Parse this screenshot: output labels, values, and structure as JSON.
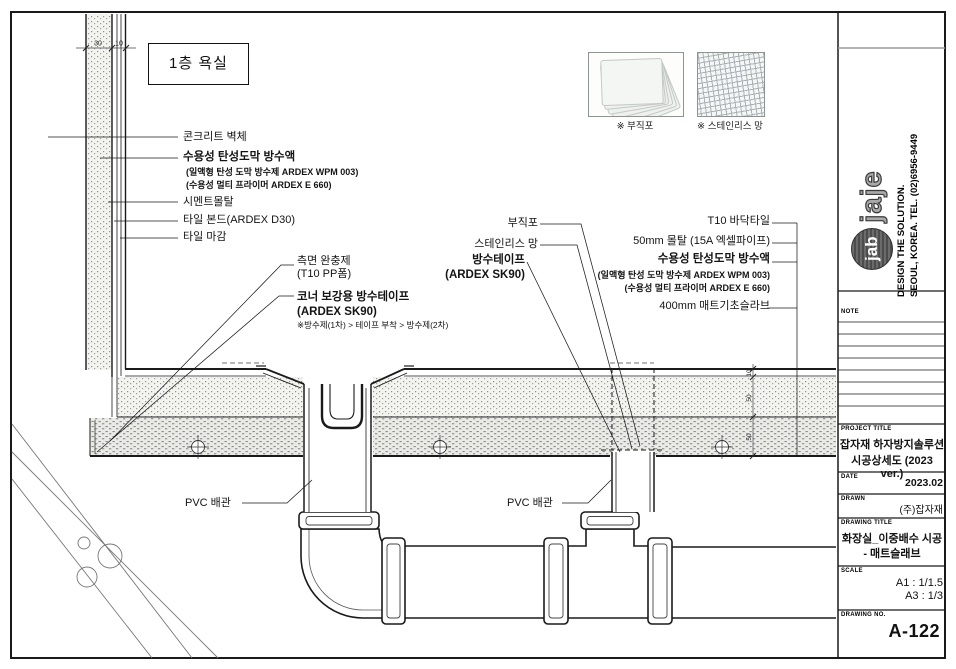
{
  "drawing": {
    "title_box": "1층 욕실",
    "legend": {
      "fabric_caption": "※ 부직포",
      "mesh_caption": "※ 스테인리스 망"
    },
    "wall_labels": {
      "concrete": "콘크리트 벽체",
      "waterproof_title": "수용성 탄성도막 방수액",
      "waterproof_sub1": "(일액형 탄성 도막 방수제 ARDEX WPM 003)",
      "waterproof_sub2": "(수용성 멀티 프라이머 ARDEX E 660)",
      "cement_mortar": "시멘트몰탈",
      "tile_bond": "타일 본드(ARDEX D30)",
      "tile_finish": "타일 마감"
    },
    "corner_labels": {
      "cushion_line1": "측면 완충제",
      "cushion_line2": "(T10 PP폼)",
      "tape_line1": "코너 보강용 방수테이프",
      "tape_line2": "(ARDEX SK90)",
      "tape_note": "※방수제(1차) > 테이프 부착 > 방수제(2차)"
    },
    "mid_labels": {
      "fabric": "부직포",
      "mesh": "스테인리스 망",
      "tape_line1": "방수테이프",
      "tape_line2": "(ARDEX SK90)"
    },
    "right_labels": {
      "floor_tile": "T10 바닥타일",
      "mortar": "50mm 몰탈  (15A 엑셀파이프)",
      "waterproof_title": "수용성 탄성도막 방수액",
      "waterproof_sub1": "(일액형 탄성 도막 방수제 ARDEX WPM 003)",
      "waterproof_sub2": "(수용성 멀티 프라이머 ARDEX E 660)",
      "slab": "400mm 매트기초슬라브"
    },
    "pvc_label_1": "PVC 배관",
    "pvc_label_2": "PVC 배관",
    "dims": {
      "wall_mortar": "30",
      "wall_tile": "10",
      "tile": "10",
      "mortar": "50",
      "bed": "50"
    }
  },
  "titleblock": {
    "logo_jab": "jab",
    "logo_jaje": "jaje",
    "tagline1": "DESIGN THE SOLUTION.",
    "tagline2": "SEOUL, KOREA. TEL. (02)6956-9449",
    "note_label": "NOTE",
    "project_label": "PROJECT TITLE",
    "project_line1": "잡자재 하자방지솔루션",
    "project_line2": "시공상세도 (2023 ver.)",
    "date_label": "DATE",
    "date_value": "2023.02",
    "drawn_label": "DRAWN",
    "drawn_value": "(주)잡자재",
    "dtitle_label": "DRAWING TITLE",
    "dtitle_line1": "화장실_이중배수 시공",
    "dtitle_line2": "- 매트슬래브",
    "scale_label": "SCALE",
    "scale_line1": "A1 : 1/1.5",
    "scale_line2": "A3 : 1/3",
    "dno_label": "DRAWING NO.",
    "dno_value": "A-122"
  }
}
